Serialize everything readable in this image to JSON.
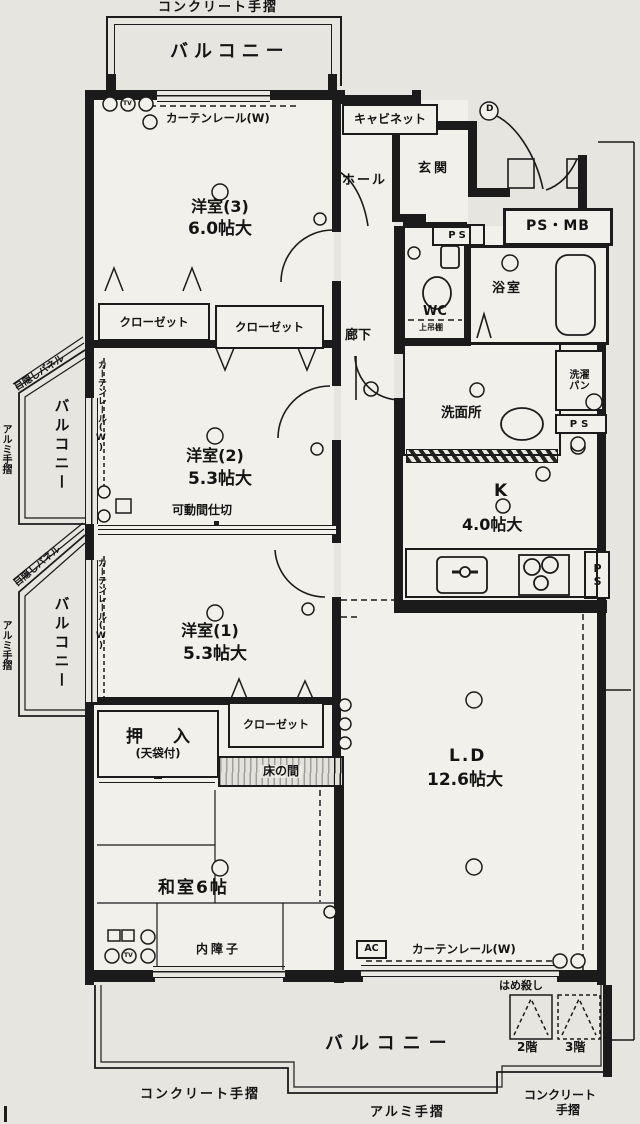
{
  "colors": {
    "paper": "#e6e5e0",
    "ink": "#1b1b1b",
    "room": "#f1f0ea"
  },
  "header": {
    "top_rail": "コンクリート手摺"
  },
  "balconies": {
    "top": "バルコニー",
    "left_upper": "バルコニー",
    "left_lower": "バルコニー",
    "bottom": "バルコニー"
  },
  "rails": {
    "bottom_left": "コンクリート手摺",
    "bottom_mid": "アルミ手摺",
    "bottom_right_line1": "コンクリート",
    "bottom_right_line2": "手摺",
    "left_upper": "アルミ手摺",
    "left_lower": "アルミ手摺"
  },
  "panels": {
    "upper": "目隠しパネル",
    "lower": "目隠しパネル"
  },
  "curtain_rails": {
    "top": "カーテンレール(W)",
    "left_upper": "カーテンレール(W)",
    "left_lower": "カーテンレール(W)",
    "bottom": "カーテンレール(W)"
  },
  "rooms": {
    "yoshitsu3": {
      "name": "洋室(3)",
      "size": "6.0帖大"
    },
    "yoshitsu2": {
      "name": "洋室(2)",
      "size": "5.3帖大"
    },
    "yoshitsu1": {
      "name": "洋室(1)",
      "size": "5.3帖大"
    },
    "washitsu": {
      "name": "和室6帖"
    },
    "living": {
      "name": "L.D",
      "size": "12.6帖大"
    },
    "kitchen": {
      "name": "K",
      "size": "4.0帖大"
    },
    "bathroom": "浴室",
    "wc": "WC",
    "wc_shelf": "上吊棚",
    "washroom": "洗面所",
    "laundry_line1": "洗濯",
    "laundry_line2": "パン",
    "hall": "ホール",
    "entrance": "玄関",
    "corridor": "廊下",
    "cabinet": "キャビネット",
    "ps_mb": "PS・MB",
    "ps": "PS"
  },
  "features": {
    "closet": "クローゼット",
    "oshiire": "押入",
    "oshiire_note": "(天袋付)",
    "tokonoma": "床の間",
    "inner_shoji": "内障子",
    "movable_partition": "可動間仕切",
    "fixed_window": "はめ殺し",
    "floor2": "2階",
    "floor3": "3階",
    "ac": "AC",
    "tv": "TV",
    "entry_mark": "D"
  }
}
